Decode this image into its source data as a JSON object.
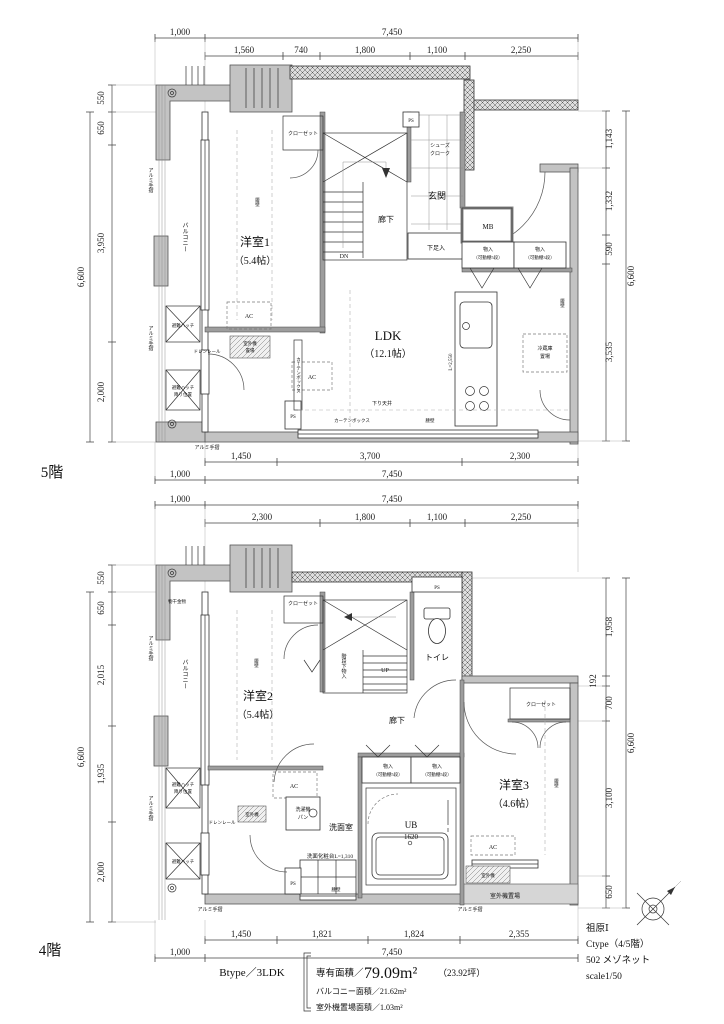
{
  "colors": {
    "wall_gray": "#c3c3c3",
    "hatch_line": "#555",
    "line": "#222",
    "background": "#ffffff"
  },
  "floor5": {
    "name": "5階",
    "dims": {
      "top_row1": [
        "1,000",
        "7,450"
      ],
      "top_row2": [
        "1,560",
        "740",
        "1,800",
        "1,100",
        "2,250"
      ],
      "bottom_row1": [
        "1,450",
        "3,700",
        "2,300"
      ],
      "bottom_row2": [
        "1,000",
        "7,450"
      ],
      "left": [
        "550",
        "650",
        "3,950",
        "2,000"
      ],
      "left_total": "6,600",
      "right": [
        "1,143",
        "1,332",
        "590",
        "3,535"
      ],
      "right_total": "6,600"
    },
    "labels": {
      "balcony": "バルコニー",
      "alum_rail": "アルミ手摺",
      "hatch": "避難ハッチ",
      "hatch_pos1": "避難ハッチ",
      "hatch_pos2": "降り位置",
      "drain_rail": "ドレンレール",
      "outdoor1": "室外機",
      "outdoor2": "置場",
      "ac": "AC",
      "curtain": "カーテンボックス",
      "koshikabe": "腰壁",
      "room1": "洋室1",
      "room1_size": "（5.4帖）",
      "closet": "クローゼット",
      "dn": "DN",
      "corridor": "廊下",
      "entrance": "玄関",
      "shoes1": "シューズ",
      "shoes2": "クローク",
      "shoebox": "下足入",
      "mb": "MB",
      "storage": "物入",
      "storage_sub5": "（可動棚5段）",
      "storage_sub3": "（可動棚3段）",
      "ps": "PS",
      "ldk": "LDK",
      "ldk_size": "（12.1帖）",
      "ceiling": "下り天井",
      "fridge1": "冷蔵庫",
      "fridge2": "置場",
      "counter_len": "L=2,550"
    }
  },
  "floor4": {
    "name": "4階",
    "dims": {
      "top_row1": [
        "1,000",
        "7,450"
      ],
      "top_row2": [
        "2,300",
        "1,800",
        "1,100",
        "2,250"
      ],
      "bottom_row1": [
        "1,450",
        "1,821",
        "1,824",
        "2,355"
      ],
      "bottom_row2": [
        "1,000",
        "7,450"
      ],
      "left": [
        "550",
        "650",
        "2,015",
        "1,935",
        "2,000"
      ],
      "left_total": "6,600",
      "right": [
        "1,958",
        "192",
        "700",
        "3,100",
        "650"
      ],
      "right_total": "6,600"
    },
    "labels": {
      "balcony": "バルコニー",
      "monohoshi": "物干金物",
      "alum_rail": "アルミ手摺",
      "hatch": "避難ハッチ",
      "hatch_pos1": "避難ハッチ",
      "hatch_pos2": "降り位置",
      "drain_rail": "ドレンレール",
      "outdoor": "室外機",
      "room2": "洋室2",
      "room2_size": "（5.4帖）",
      "koshikabe": "腰壁",
      "closet": "クローゼット",
      "stair_storage": "階段下物入",
      "up": "UP",
      "toilet": "トイレ",
      "ps": "PS",
      "corridor": "廊下",
      "storage": "物入",
      "storage_sub": "（可動棚5段）",
      "ac": "AC",
      "washer1": "洗濯機",
      "washer2": "パン",
      "washroom": "洗面室",
      "ub": "UB",
      "ub_size": "1620",
      "vanity": "洗面化粧台L=1,310",
      "room3": "洋室3",
      "room3_size": "（4.6帖）",
      "outdoor_place": "室外機置場"
    }
  },
  "footer": {
    "type_label": "Btype／3LDK",
    "area_label": "専有面積／",
    "area_value": "79.09m²",
    "area_tsubo": "（23.92坪）",
    "balcony_area": "バルコニー面積／21.62m²",
    "outdoor_area": "室外機置場面積／1.03m²"
  },
  "title_block": {
    "project": "祖原Ⅰ",
    "plan_type": "Ctype（4/5階）",
    "unit": "502 メゾネット",
    "scale": "scale1/50"
  }
}
